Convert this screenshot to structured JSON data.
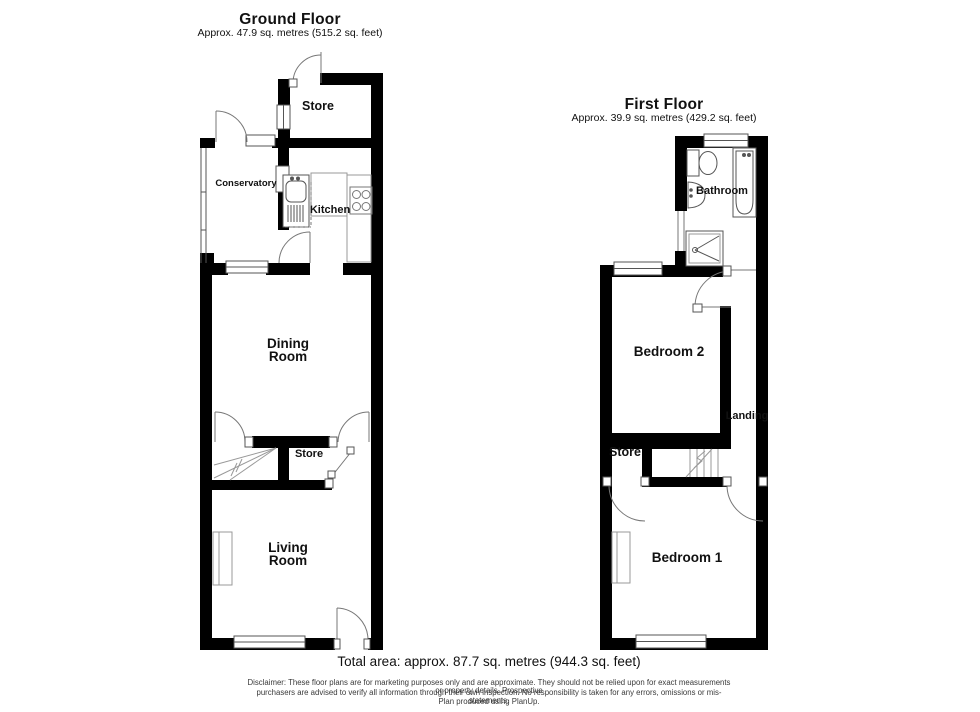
{
  "ground_floor": {
    "title": "Ground Floor",
    "subtitle": "Approx. 47.9 sq. metres (515.2 sq. feet)",
    "rooms": {
      "store_top": "Store",
      "conservatory": "Conservatory",
      "kitchen": "Kitchen",
      "dining": "Dining\nRoom",
      "store_mid": "Store",
      "living": "Living\nRoom"
    }
  },
  "first_floor": {
    "title": "First Floor",
    "subtitle": "Approx. 39.9 sq. metres (429.2 sq. feet)",
    "rooms": {
      "bathroom": "Bathroom",
      "bedroom2": "Bedroom 2",
      "landing": "Landing",
      "store": "Store",
      "bedroom1": "Bedroom 1"
    }
  },
  "footer": {
    "total_area": "Total area: approx. 87.7 sq. metres (944.3 sq. feet)",
    "disclaimer": [
      "Disclaimer: These floor plans are for marketing purposes only and are approximate. They should not be relied upon for exact measurements or property details. Prospective",
      "purchasers are advised to verify all information through their own inspection. No responsibility is taken for any errors, omissions or mis-statements.",
      "Plan produced using PlanUp."
    ]
  },
  "colors": {
    "wall": "#000000",
    "thin_line": "#666666",
    "text": "#111111"
  }
}
